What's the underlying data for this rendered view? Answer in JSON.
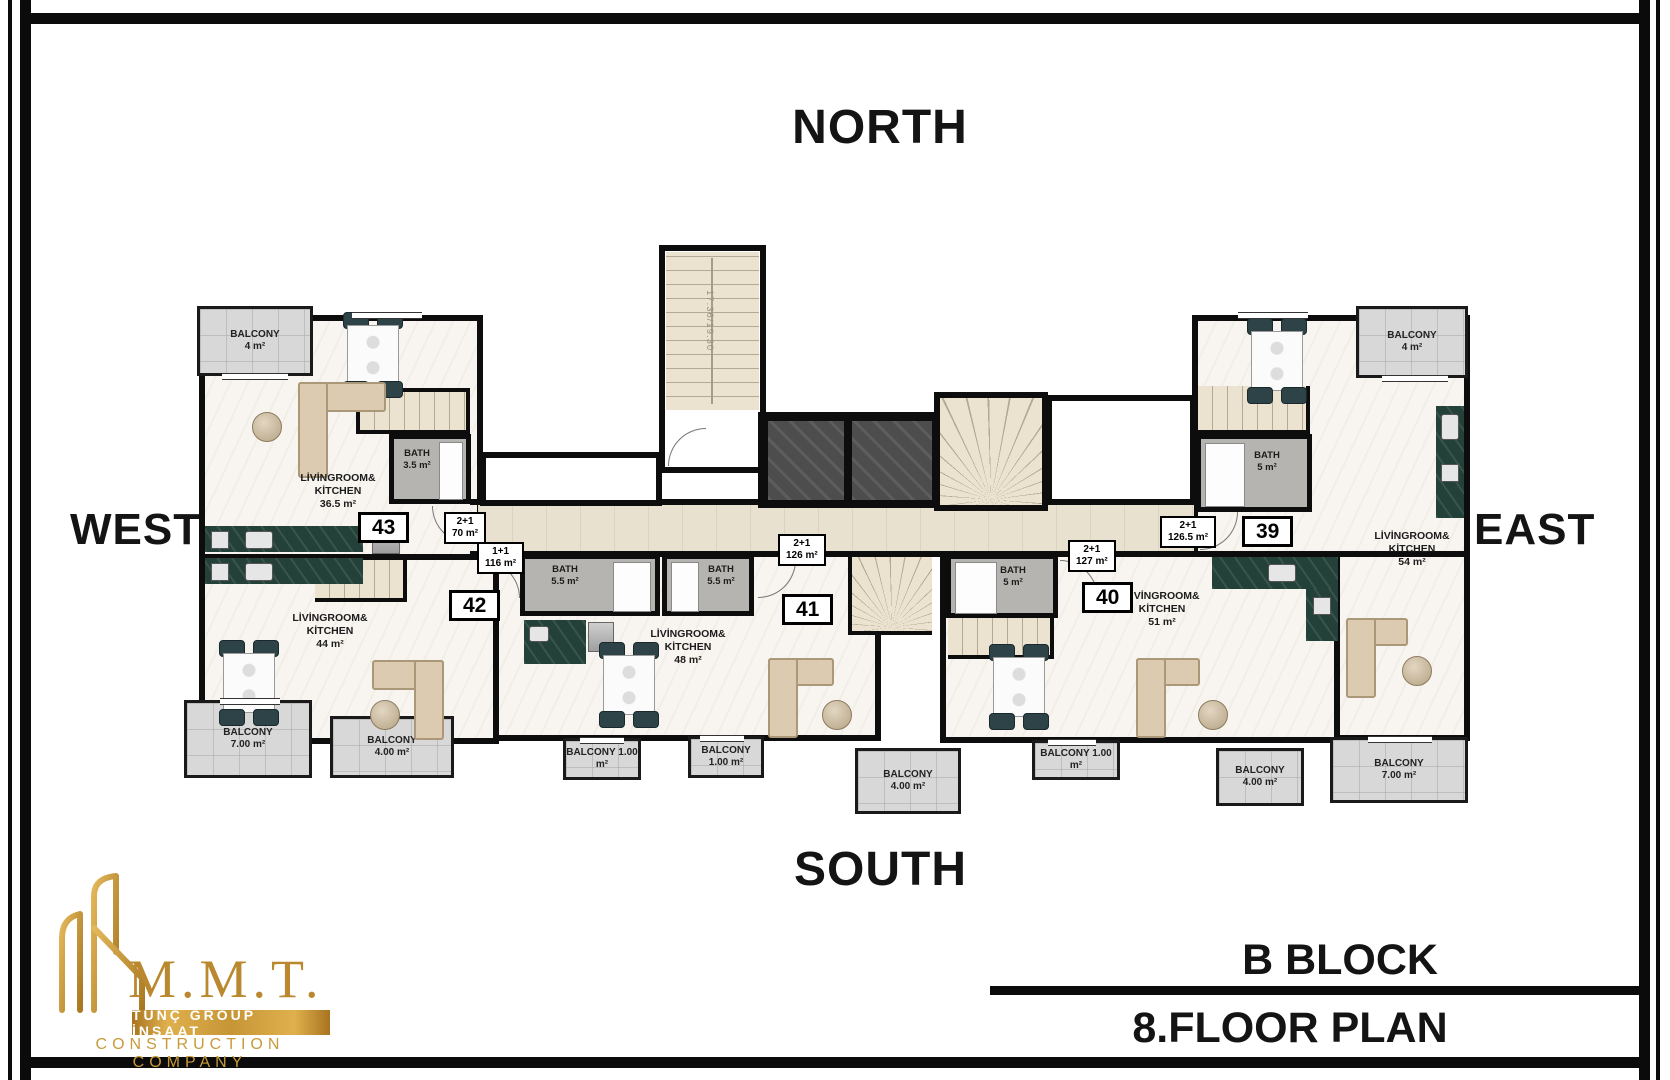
{
  "compass": {
    "north": "NORTH",
    "south": "SOUTH",
    "west": "WEST",
    "east": "EAST"
  },
  "title_block": {
    "block": "B BLOCK",
    "plan": "8.FLOOR PLAN"
  },
  "logo": {
    "initials": "M.M.T.",
    "band": "TUNÇ GROUP İNŞAAT",
    "subtitle": "CONSTRUCTION COMPANY"
  },
  "labels": {
    "balcony": "BALCONY",
    "bath": "BATH",
    "living1": "LİVİNGROOM&",
    "living2": "KİTCHEN"
  },
  "core": {
    "stair_dimension": "17.36/19.30"
  },
  "units": {
    "u43": {
      "number": "43",
      "type1": "2+1",
      "type2": "70 m²",
      "living_area": "36.5 m²",
      "bath_area": "3.5 m²",
      "bal1_area": "4 m²"
    },
    "u42": {
      "number": "42",
      "type1": "1+1",
      "type2": "116 m²",
      "living_area": "44 m²",
      "bath_area": "5.5 m²",
      "bal1_area": "7.00 m²",
      "bal2_area": "4.00 m²"
    },
    "u41": {
      "number": "41",
      "type1": "2+1",
      "type2": "126 m²",
      "living_area": "48 m²",
      "bath_area": "5.5 m²",
      "bal1_area": "1.00 m²",
      "bal2_area": "1.00 m²",
      "bal3_area": "4.00 m²"
    },
    "u40": {
      "number": "40",
      "type1": "2+1",
      "type2": "127 m²",
      "living_area": "51 m²",
      "bath_area": "5 m²",
      "bal1_area": "1.00 m²",
      "bal2_area": "4.00 m²"
    },
    "u39": {
      "number": "39",
      "type1": "2+1",
      "type2": "126.5 m²",
      "living_area": "54 m²",
      "bath_area": "5 m²",
      "bal1_area": "4 m²",
      "bal2_area": "7.00 m²"
    }
  },
  "colors": {
    "gold": "#c79a3c",
    "wall": "#0d0d0d",
    "balcony_gray": "#d8d8d8",
    "kitchen_green": "#234139",
    "bath_gray": "#b6b4b1",
    "floor": "#f8f5f0",
    "stair_beige": "#ebe3d0",
    "elevator_gray": "#4d4d4d"
  }
}
